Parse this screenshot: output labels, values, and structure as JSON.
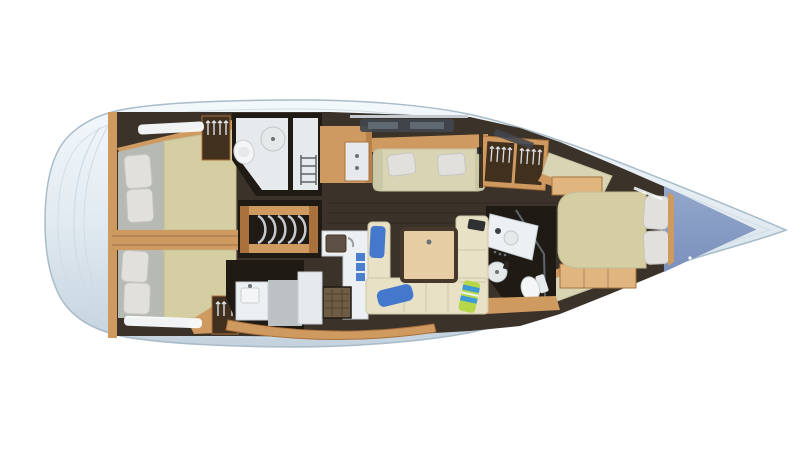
{
  "meta": {
    "title": "Sailing yacht interior layout plan - top view",
    "description": "3D rendered deck plan of a three-cabin sailing yacht, bow to the right, stern to the left",
    "orientation": {
      "bow": "right",
      "stern": "left",
      "port_side": "top",
      "starboard_side": "bottom"
    }
  },
  "palette": {
    "page_bg": "#ffffff",
    "hull_deck_light": "#f3f8fb",
    "hull_deck": "#e1eaf1",
    "hull_edge": "#c3d2dd",
    "hull_stroke": "#a8bcca",
    "deck_line": "#cfdbe4",
    "interior_floor": "#3b322a",
    "bulkhead": "#201a15",
    "wood": "#cf9a60",
    "wood_dark": "#a9713c",
    "wood_light": "#e0b57f",
    "mattress": "#d5cea2",
    "mattress_edge": "#c2bb92",
    "bed_gray": "#b7bab2",
    "pillow": "#e1e0dc",
    "pillow_edge": "#c6c5c0",
    "settee": "#d9d5b4",
    "settee_edge": "#c5c2a0",
    "seat_cream": "#e8e1c6",
    "seat_seam": "#cfc6a6",
    "table_top": "#e6cda4",
    "table_frame": "#46382a",
    "counter": "#edf0f2",
    "counter_edge": "#c7cfd4",
    "sink_dark": "#5c5144",
    "fixture_white": "#f3f5f6",
    "fixture_edge": "#c8ced1",
    "head_floor": "#bcc1c4",
    "head_floor_light": "#e6eaec",
    "disc": "#e6e9ea",
    "disc_edge": "#c0c6c9",
    "metal": "#c4cad0",
    "accent_blue": "#4478cc",
    "stripe_green": "#b5d748",
    "stripe_blue": "#3e9ad6",
    "stripe_light": "#eaf4f8",
    "bow_blue": "#93a7cb",
    "bow_blue_deep": "#7b90bc",
    "locker": "#42301f",
    "hanger": "#dde1e5",
    "hatch_glow": "#fafdfe",
    "window_dark": "#40474e",
    "window_light": "#6c757d",
    "stove": "#6e5c44",
    "stove_line": "#52432e"
  },
  "hull": {
    "label": "Hull and side decks"
  },
  "rooms": {
    "bow_locker": {
      "label": "Bow locker / forepeak"
    },
    "owner_cabin": {
      "label": "Forward owner's cabin with island double berth"
    },
    "forward_head": {
      "label": "Forward head with washbasin, shower and toilet"
    },
    "wardrobe": {
      "label": "Owner's cabin hanging lockers"
    },
    "salon_settee": {
      "label": "Saloon straight settee (port)"
    },
    "dinette": {
      "label": "Saloon dinette with table (starboard)"
    },
    "galley": {
      "label": "L-shaped galley with sink and stove"
    },
    "day_head": {
      "label": "Aft head with shower and toilet (port)"
    },
    "aft_shower": {
      "label": "Aft shower room with washbasin (starboard)"
    },
    "companionway": {
      "label": "Companionway steps to cockpit"
    },
    "aft_cabin_port": {
      "label": "Aft guest cabin with double berth (port)"
    },
    "aft_cabin_starboard": {
      "label": "Aft guest cabin with double berth (starboard)"
    }
  },
  "furniture": {
    "berth": "Double berth",
    "pillow": "Pillow",
    "hanging_locker": "Hanging locker with hangers",
    "table": "Saloon table",
    "settee": "Settee cushions",
    "sink": "Galley sink",
    "stove": "Stove / galley unit",
    "toilet": "Toilet",
    "shower": "Shower tray",
    "washbasin": "Washbasin",
    "steps": "Companionway steps",
    "deck_hatch": "Deck hatch",
    "coachroof_window": "Coachroof window",
    "accent_pillow_blue": "Blue accent pillow",
    "accent_pillow_striped": "Striped accent pillow",
    "sideboard": "Galley sideboard with fridge panel",
    "chaise": "Hull-side lounge seat"
  }
}
